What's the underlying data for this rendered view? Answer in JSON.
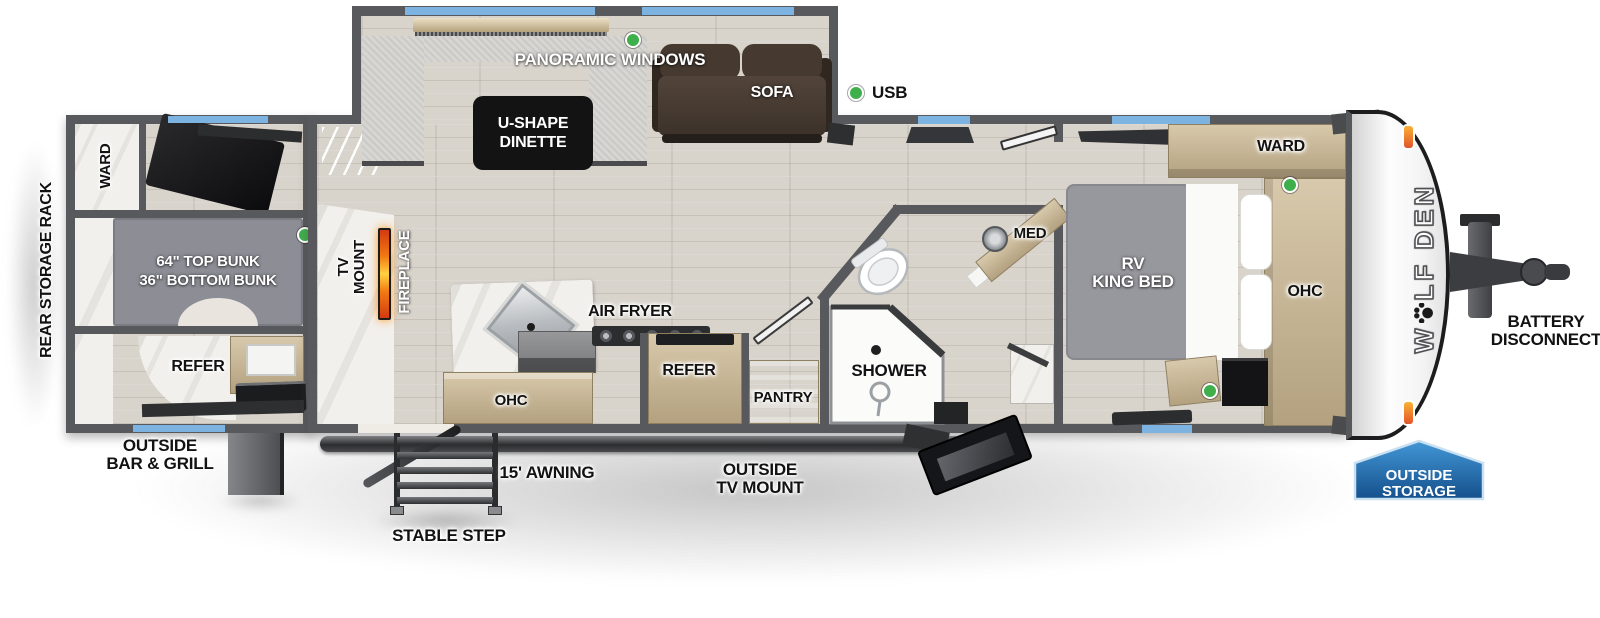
{
  "logo": {
    "prefix": "W",
    "suffix": "LF DEN",
    "icon": "paw-print"
  },
  "rear": {
    "side_label": "REAR STORAGE RACK",
    "ward": "WARD",
    "bunk_line1": "64\" TOP BUNK",
    "bunk_line2": "36\" BOTTOM BUNK",
    "refer": "REFER",
    "exterior_line1": "OUTSIDE",
    "exterior_line2": "BAR & GRILL"
  },
  "slideout": {
    "windows": "PANORAMIC WINDOWS",
    "dinette_line1": "U-SHAPE",
    "dinette_line2": "DINETTE",
    "sofa": "SOFA"
  },
  "living": {
    "usb": "USB",
    "tv_line1": "TV",
    "tv_line2": "MOUNT",
    "fireplace": "FIREPLACE"
  },
  "kitchen": {
    "air_fryer": "AIR FRYER",
    "refer": "REFER",
    "ohc": "OHC",
    "pantry": "PANTRY"
  },
  "bath": {
    "med": "MED",
    "shower": "SHOWER"
  },
  "bedroom": {
    "bed_line1": "RV",
    "bed_line2": "KING BED",
    "ward": "WARD",
    "ohc": "OHC"
  },
  "exterior": {
    "awning": "15' AWNING",
    "step": "STABLE STEP",
    "tv_line1": "OUTSIDE",
    "tv_line2": "TV MOUNT",
    "battery_line1": "BATTERY",
    "battery_line2": "DISCONNECT",
    "storage_line1": "OUTSIDE",
    "storage_line2": "STORAGE"
  },
  "colors": {
    "wall_gray": "#58595c",
    "floor_wood": "#d8d3cb",
    "window_blue": "#7db3e1",
    "indicator_green": "#3faf4b",
    "cabinet_tan": "#c7b696",
    "storage_badge_blue": "#1d5c9c",
    "fireplace_orange": "#f07b12",
    "marker_light_amber": "#f5a623"
  }
}
